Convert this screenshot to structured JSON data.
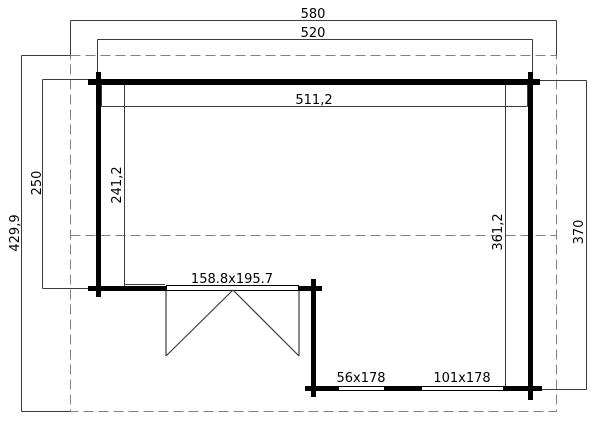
{
  "plan": {
    "dim_overall_width": "580",
    "dim_wall_outer_width": "520",
    "dim_inner_width": "511,2",
    "dim_inner_depth_left": "241,2",
    "dim_left_section_depth": "250",
    "dim_overall_depth": "429,9",
    "dim_inner_depth_right": "361,2",
    "dim_right_section_depth": "370",
    "door_size": "158.8x195.7",
    "window_small_size": "56x178",
    "window_large_size": "101x178",
    "colors": {
      "wall": "#000000",
      "dimension_line": "#3c3c3c",
      "dashed_roof_outline": "#828282",
      "text": "#000000",
      "background": "#ffffff"
    }
  }
}
